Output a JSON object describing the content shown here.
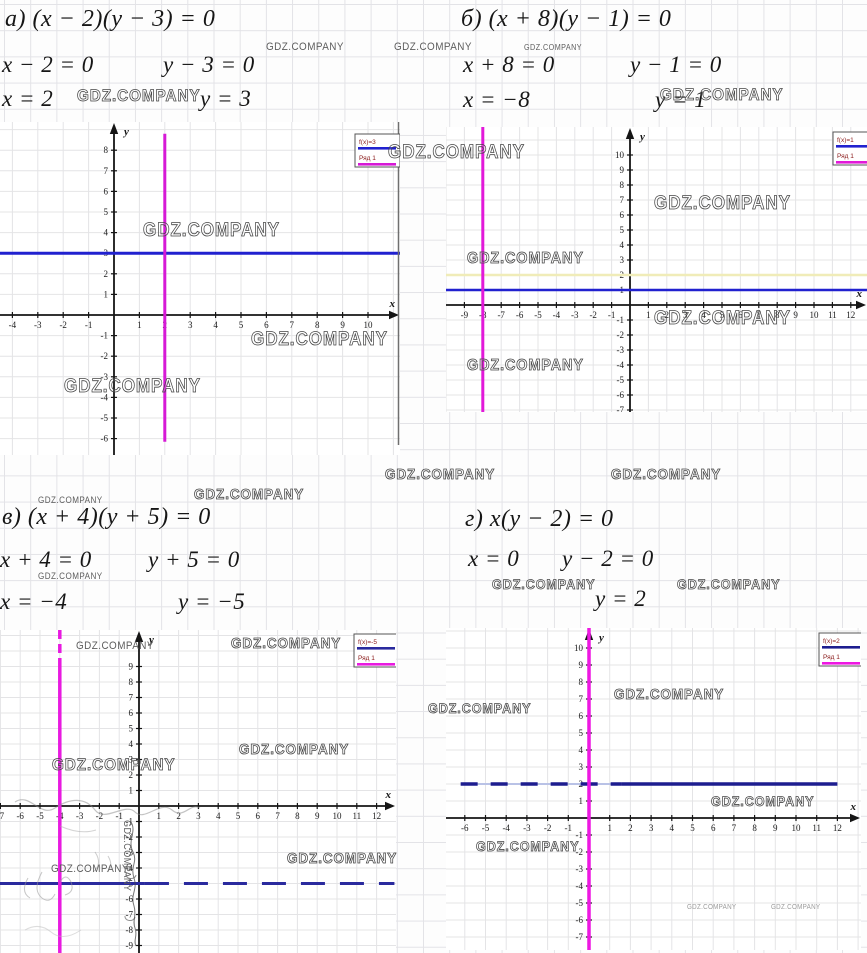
{
  "page": {
    "width": 867,
    "height": 953
  },
  "watermark": {
    "text": "GDZ.COMPANY",
    "items": [
      {
        "x": 266,
        "y": 42,
        "s": 11
      },
      {
        "x": 394,
        "y": 42,
        "s": 11
      },
      {
        "x": 77,
        "y": 87,
        "s": 17,
        "o": 1
      },
      {
        "x": 524,
        "y": 44,
        "s": 8
      },
      {
        "x": 660,
        "y": 86,
        "s": 17,
        "o": 1
      },
      {
        "x": 143,
        "y": 221,
        "s": 19,
        "o": 1
      },
      {
        "x": 251,
        "y": 330,
        "s": 19,
        "o": 1
      },
      {
        "x": 64,
        "y": 377,
        "s": 19,
        "o": 1
      },
      {
        "x": 388,
        "y": 143,
        "s": 19,
        "o": 1
      },
      {
        "x": 654,
        "y": 194,
        "s": 19,
        "o": 1
      },
      {
        "x": 467,
        "y": 251,
        "s": 16,
        "o": 1
      },
      {
        "x": 654,
        "y": 309,
        "s": 19,
        "o": 1
      },
      {
        "x": 467,
        "y": 358,
        "s": 16,
        "o": 1
      },
      {
        "x": 385,
        "y": 467,
        "s": 15,
        "o": 1
      },
      {
        "x": 611,
        "y": 467,
        "s": 15,
        "o": 1
      },
      {
        "x": 38,
        "y": 496,
        "s": 9
      },
      {
        "x": 194,
        "y": 487,
        "s": 15,
        "o": 1
      },
      {
        "x": 38,
        "y": 572,
        "s": 9
      },
      {
        "x": 492,
        "y": 577,
        "s": 14,
        "o": 1
      },
      {
        "x": 677,
        "y": 577,
        "s": 14,
        "o": 1
      },
      {
        "x": 76,
        "y": 641,
        "s": 11
      },
      {
        "x": 231,
        "y": 636,
        "s": 15,
        "o": 1
      },
      {
        "x": 52,
        "y": 756,
        "s": 17,
        "o": 1
      },
      {
        "x": 239,
        "y": 742,
        "s": 15,
        "o": 1
      },
      {
        "x": 287,
        "y": 851,
        "s": 15,
        "o": 1
      },
      {
        "x": 51,
        "y": 864,
        "s": 11
      },
      {
        "x": 428,
        "y": 701,
        "s": 14,
        "o": 1
      },
      {
        "x": 614,
        "y": 687,
        "s": 15,
        "o": 1
      },
      {
        "x": 711,
        "y": 794,
        "s": 14,
        "o": 1
      },
      {
        "x": 476,
        "y": 839,
        "s": 14,
        "o": 1
      },
      {
        "x": 687,
        "y": 904,
        "s": 7,
        "tiny": 1
      },
      {
        "x": 771,
        "y": 904,
        "s": 7,
        "tiny": 1
      },
      {
        "x": 131,
        "y": 820,
        "s": 10,
        "r": 1
      }
    ]
  },
  "problems": [
    {
      "label": "а)",
      "equation": "а) (x − 2)(y − 3) = 0",
      "factor1": "x − 2 = 0",
      "factor2": "y − 3 = 0",
      "root1": "x = 2",
      "root2": "y = 3"
    },
    {
      "label": "б)",
      "equation": "б) (x + 8)(y − 1) = 0",
      "factor1": "x + 8 = 0",
      "factor2": "y − 1 = 0",
      "root1": "x = −8",
      "root2": "y = 1"
    },
    {
      "label": "в)",
      "equation": "в) (x + 4)(y + 5) = 0",
      "factor1": "x + 4 = 0",
      "factor2": "y + 5 = 0",
      "root1": "x = −4",
      "root2": "y = −5"
    },
    {
      "label": "г)",
      "equation": "г) x(y − 2) = 0",
      "factor1": "x = 0",
      "factor2": "y − 2 = 0",
      "root1": "",
      "root2": "y = 2"
    }
  ],
  "chart_data": [
    {
      "type": "line",
      "title": "",
      "xlabel": "x",
      "ylabel": "y",
      "xlim": [
        -4,
        10
      ],
      "ylim": [
        -6,
        8
      ],
      "grid": true,
      "legend_position": "top-right",
      "legend": [
        {
          "label": "f(x)=3",
          "color": "#2121cf"
        },
        {
          "label": "Ряд 1",
          "color": "#d619d6"
        }
      ],
      "series": [
        {
          "name": "f(x)=3",
          "kind": "hline",
          "y": 3,
          "color": "#2121cf",
          "w": 3
        },
        {
          "name": "Ряд 1",
          "kind": "vline",
          "x": 2,
          "color": "#d619d6",
          "w": 3,
          "yrange": [
            -6.15,
            8.8
          ]
        }
      ]
    },
    {
      "type": "line",
      "title": "",
      "xlabel": "x",
      "ylabel": "y",
      "xlim": [
        -9,
        12
      ],
      "ylim": [
        -7,
        10
      ],
      "grid": true,
      "legend_position": "top-right",
      "legend": [
        {
          "label": "f(x)=1",
          "color": "#2121cf"
        },
        {
          "label": "Ряд 1",
          "color": "#e219d9"
        }
      ],
      "series": [
        {
          "name": "",
          "kind": "hline",
          "y": 2,
          "color": "#f0ecb8",
          "w": 2.5
        },
        {
          "name": "f(x)=1",
          "kind": "hline",
          "y": 1,
          "color": "#2121cf",
          "w": 2.5
        },
        {
          "name": "Ряд 1",
          "kind": "vline",
          "x": -8,
          "color": "#e219d9",
          "w": 3
        }
      ]
    },
    {
      "type": "line",
      "title": "",
      "xlabel": "x",
      "ylabel": "y",
      "xlim": [
        -7,
        12
      ],
      "ylim": [
        -9,
        9
      ],
      "grid": true,
      "legend_position": "top-right",
      "legend": [
        {
          "label": "f(x)=-5",
          "color": "#2a2a9e"
        },
        {
          "label": "Ряд 1",
          "color": "#e81ae0"
        }
      ],
      "series": [
        {
          "name": "f(x)=-5",
          "kind": "hline",
          "y": -5,
          "color": "#2a2a9e",
          "w": 3,
          "xrange": [
            -7.1,
            0.3
          ]
        },
        {
          "name": "f(x)=-5",
          "kind": "hline",
          "y": -5,
          "color": "#2a2a9e",
          "w": 3,
          "xrange": [
            0.3,
            12.9
          ],
          "dash": [
            24,
            15
          ]
        },
        {
          "name": "Ряд 1",
          "kind": "vline",
          "x": -4,
          "color": "#e81ae0",
          "w": 3.5,
          "yrange": [
            9.0,
            11.5
          ],
          "dash": [
            9,
            5
          ]
        },
        {
          "name": "Ряд 1",
          "kind": "vline",
          "x": -4,
          "color": "#e81ae0",
          "w": 3.5,
          "yrange": [
            -9.6,
            9.0
          ]
        }
      ]
    },
    {
      "type": "line",
      "title": "",
      "xlabel": "x",
      "ylabel": "y",
      "xlim": [
        -6,
        12
      ],
      "ylim": [
        -7,
        10
      ],
      "grid": true,
      "legend_position": "top-right",
      "legend": [
        {
          "label": "f(x)=2",
          "color": "#1d1d8f"
        },
        {
          "label": "Ряд 1",
          "color": "#ee17e2"
        }
      ],
      "series": [
        {
          "name": "",
          "kind": "hline",
          "y": 2,
          "color": "#b9c2e6",
          "w": 2,
          "xrange": [
            -6.2,
            12.0
          ]
        },
        {
          "name": "f(x)=2",
          "kind": "hline",
          "y": 2,
          "color": "#1d1d8f",
          "w": 3.5,
          "xrange": [
            -6.2,
            1.55
          ],
          "dash": [
            17,
            13
          ]
        },
        {
          "name": "f(x)=2",
          "kind": "hline",
          "y": 2,
          "color": "#1d1d8f",
          "w": 3.5,
          "xrange": [
            1.55,
            12.0
          ]
        },
        {
          "name": "Ряд 1",
          "kind": "vline",
          "x": 0,
          "color": "#ee17e2",
          "w": 3.5
        }
      ]
    }
  ]
}
